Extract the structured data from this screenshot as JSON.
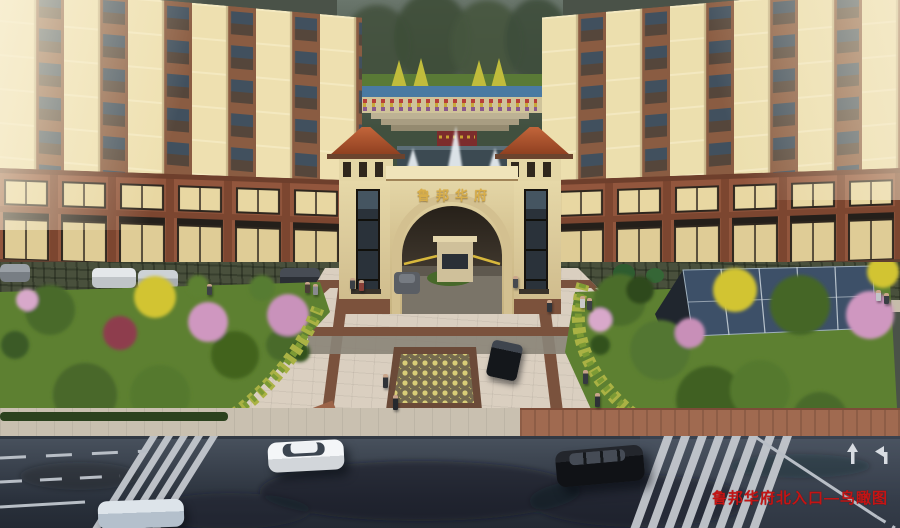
{
  "scene": {
    "type": "architectural aerial rendering of residential complex north entrance",
    "gate": {
      "sign_text": "鲁邦华府"
    },
    "watermark": {
      "text": "鲁邦华府北入口—鸟瞰图",
      "color": "#c41414"
    }
  },
  "palette": {
    "facade_cream": "#eee0b0",
    "facade_window_band": "#8a5c42",
    "window_glass": "#41505e",
    "podium_brick": "#92563d",
    "storefront_glow": "#e8d7a2",
    "gate_stone": "#ddcc9c",
    "roof_terracotta": "#b85a32",
    "gold_sign": "#d8ae4a",
    "plaza_paving": "#dacfc0",
    "plaza_band_brown": "#7a523d",
    "mosaic_dot": "#d9cd77",
    "lawn_green": "#5d8031",
    "tree_green": "#4a6b2a",
    "blossom_pink": "#cf97c0",
    "ginkgo_yellow": "#d2c433",
    "canopy_glass": "#3d5068",
    "road_asphalt": "#313947",
    "crosswalk_white": "#c8ccd2",
    "watermark_red": "#c41414"
  },
  "elements": [
    "left-residential-tower",
    "right-residential-tower",
    "retail-podium-storefronts",
    "entrance-gate-arch",
    "gate-side-towers",
    "guard-booth",
    "boom-barriers",
    "inner-courtyard-fountain",
    "terraced-garden",
    "central-plaza",
    "mosaic-parterre",
    "left-garden",
    "right-garden",
    "glass-canopy",
    "surface-parking",
    "sidewalk",
    "city-road",
    "zebra-crosswalks",
    "lane-markings",
    "white-sedan",
    "black-suv",
    "blue-sedan",
    "plaza-car",
    "pedestrians"
  ]
}
